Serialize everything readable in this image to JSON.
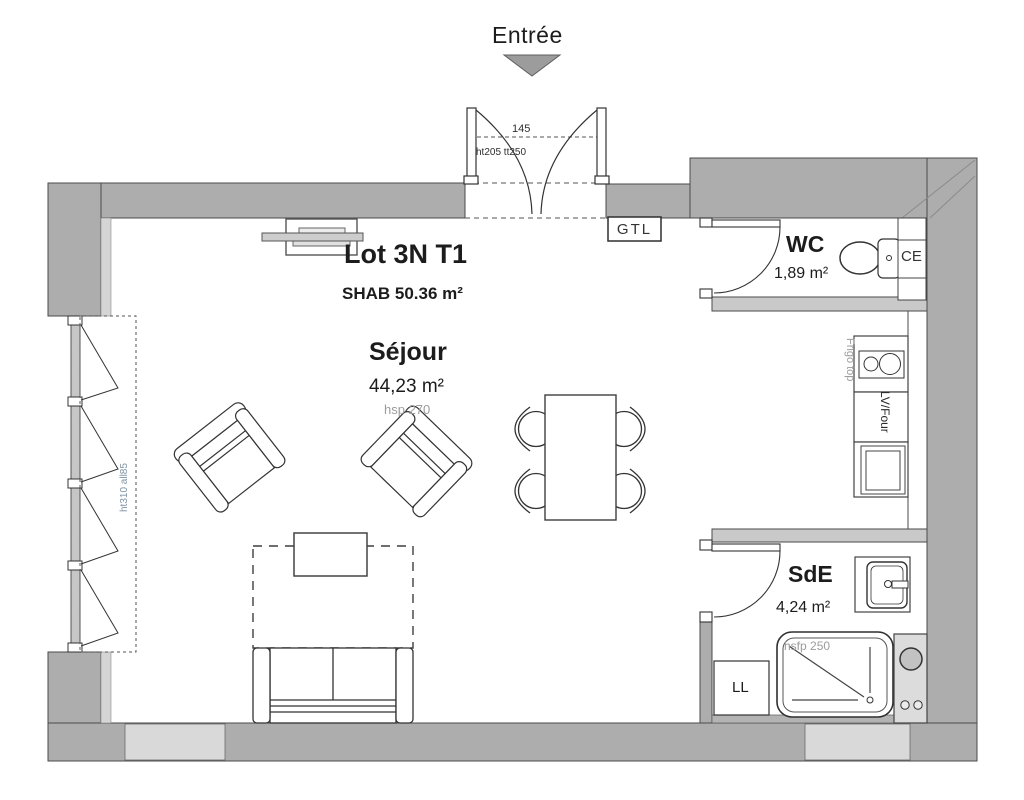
{
  "plan": {
    "entrance": {
      "label": "Entrée",
      "width_dim": "145",
      "door_dim": "ht205 tt250"
    },
    "title": {
      "lot": "Lot 3N T1",
      "shab": "SHAB 50.36 m²"
    },
    "rooms": {
      "sejour": {
        "name": "Séjour",
        "area": "44,23 m²",
        "ceiling": "hsp 270"
      },
      "wc": {
        "name": "WC",
        "area": "1,89 m²"
      },
      "sde": {
        "name": "SdE",
        "area": "4,24 m²",
        "ceiling": "hsfp 250"
      }
    },
    "equipment": {
      "gtl": "GTL",
      "ce": "CE",
      "ll": "LL",
      "frigo": "Frigo top",
      "lv_four": "LV/Four"
    },
    "window": {
      "dim": "ht310 all85"
    },
    "colors": {
      "wall": "#adadad",
      "wall_light": "#d9d9d9",
      "partition": "#c9c9c9",
      "line": "#3d3d3d",
      "muted_text": "#9c9c9c",
      "window_text": "#7f93a6",
      "arrow": "#9c9c9c"
    }
  }
}
